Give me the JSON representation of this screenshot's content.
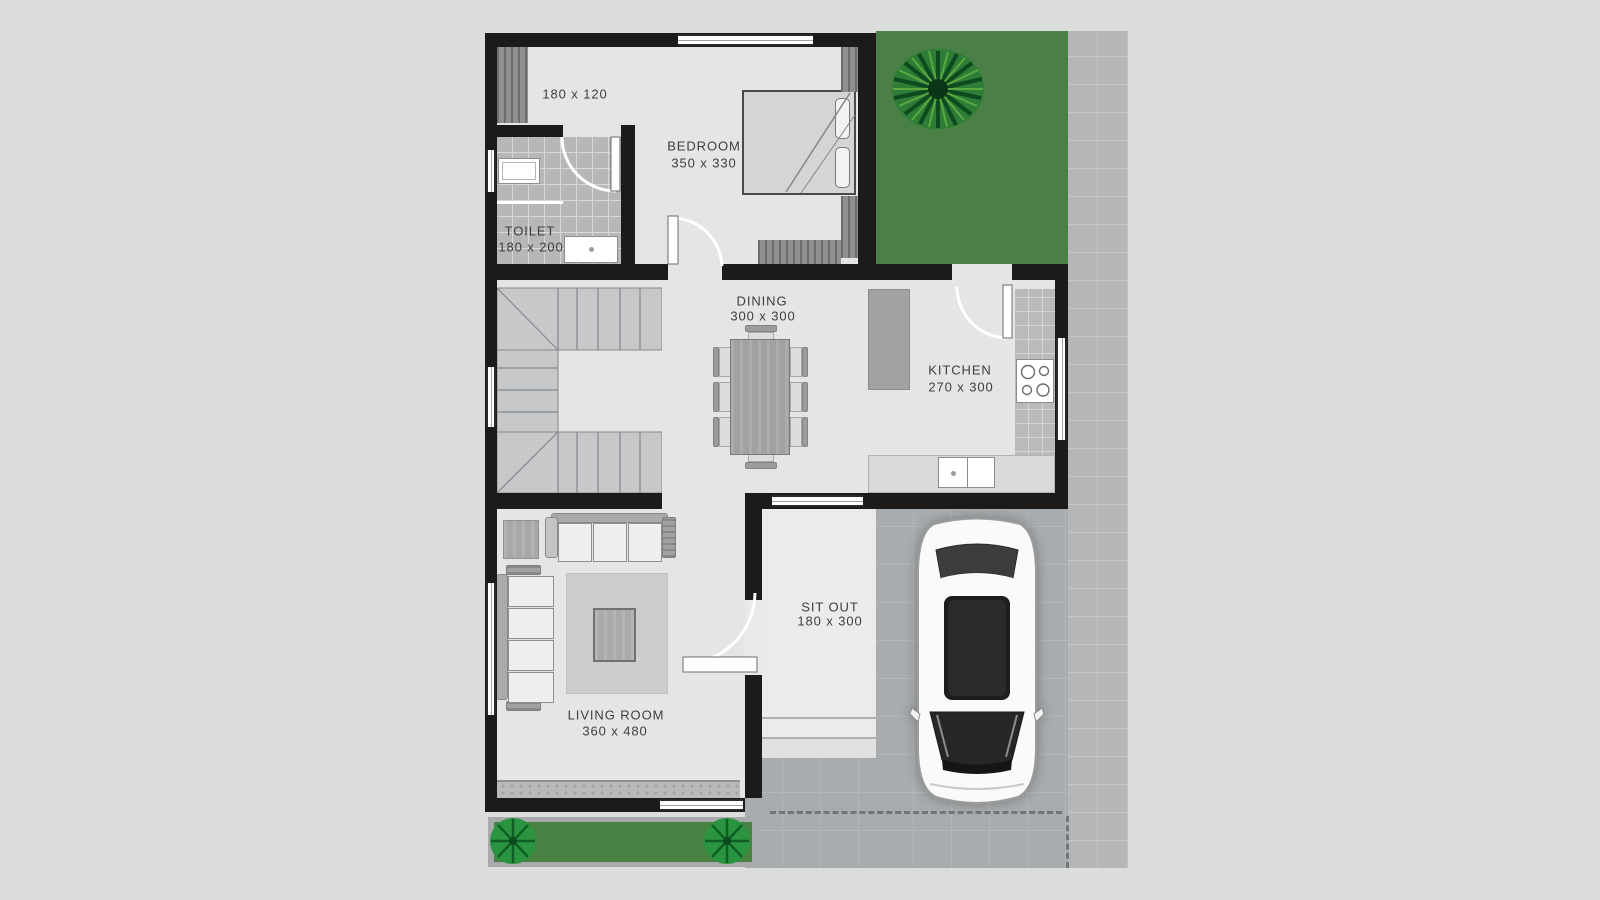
{
  "plan": {
    "title": "house-floor-plan",
    "rooms": {
      "open_area": {
        "dims": "180 x 120"
      },
      "toilet": {
        "label": "TOILET",
        "dims": "180 x 200"
      },
      "bedroom": {
        "label": "BEDROOM",
        "dims": "350 x 330"
      },
      "dining": {
        "label": "DINING",
        "dims": "300 x 300"
      },
      "kitchen": {
        "label": "KITCHEN",
        "dims": "270 x 300"
      },
      "living_room": {
        "label": "LIVING ROOM",
        "dims": "360 x 480"
      },
      "sit_out": {
        "label": "SIT OUT",
        "dims": "180 x 300"
      }
    },
    "colors": {
      "background": "#dadddb",
      "wall": "#1c1b19",
      "floor": "#e4e5e4",
      "tile": "#b5b7b9",
      "garden_green": "#4a8045",
      "driveway": "#a9acae",
      "paving": "#b4b6b8"
    }
  }
}
